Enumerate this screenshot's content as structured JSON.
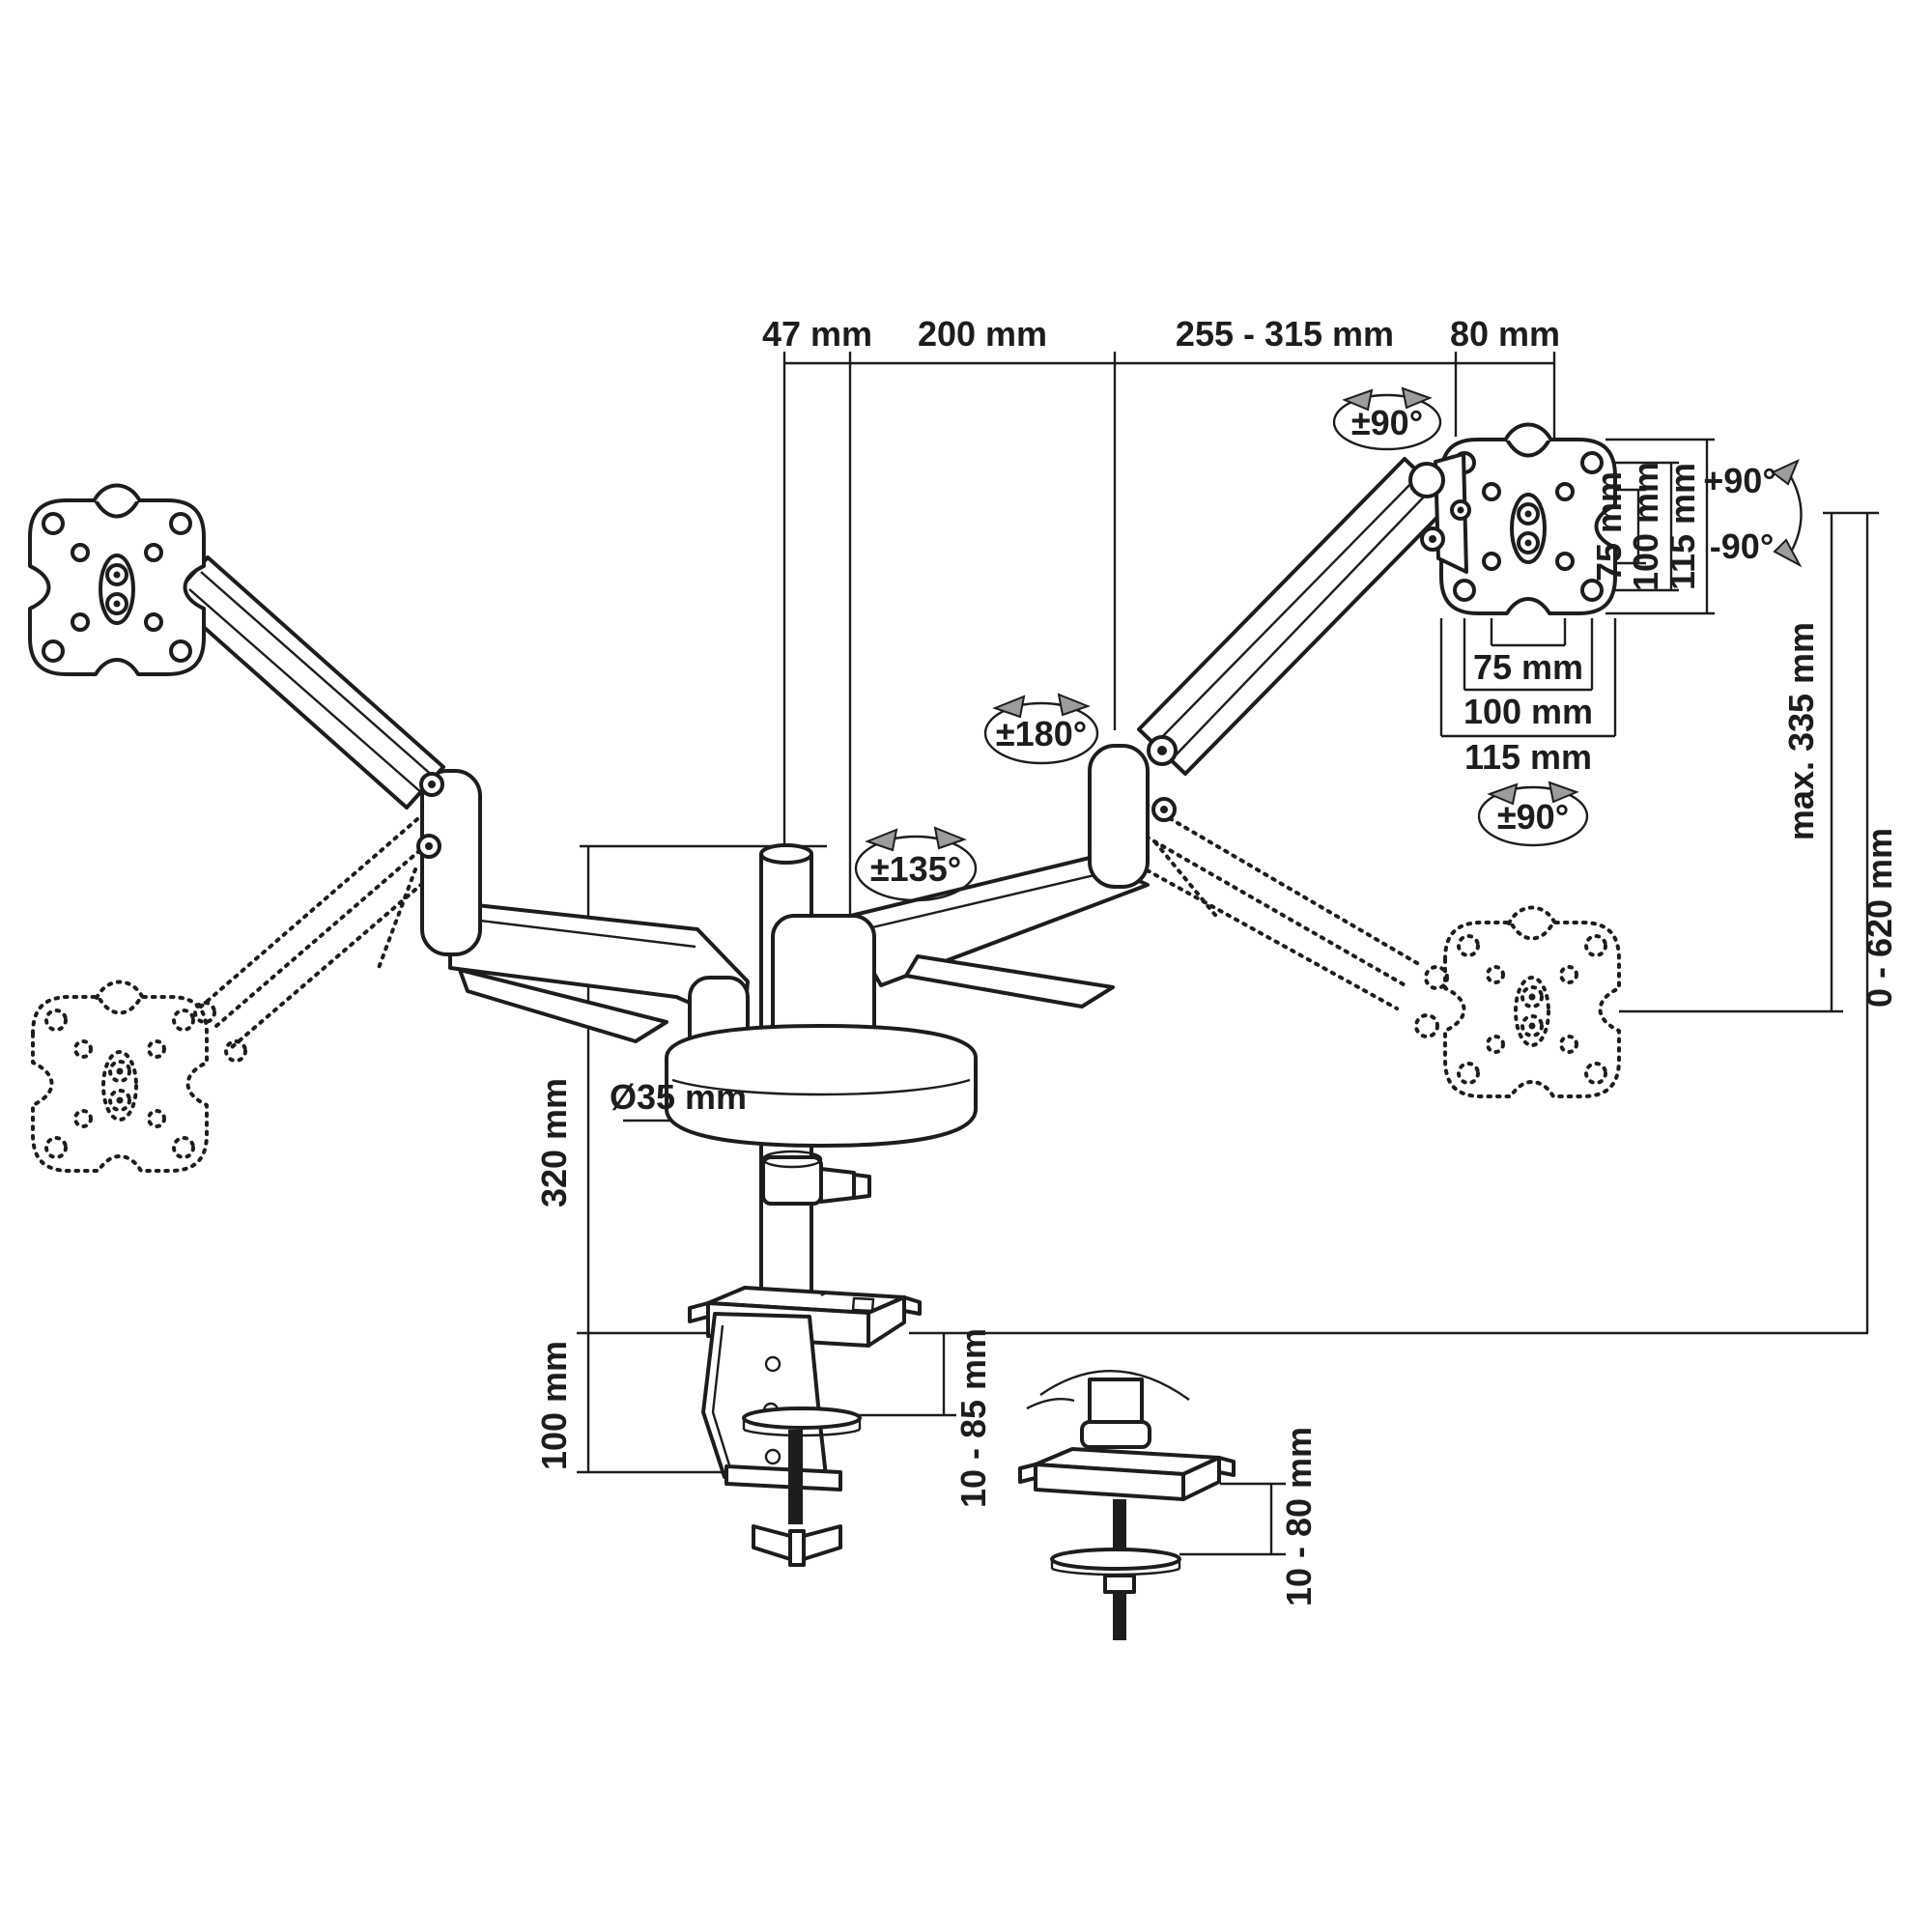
{
  "figure": {
    "type": "technical-dimension-drawing",
    "subject": "dual-monitor gas-spring desk mount arm",
    "background_color": "#ffffff",
    "line_color": "#1d1d1b",
    "arrow_color": "#9c9c9b"
  },
  "dims": {
    "top": {
      "d47": "47 mm",
      "d200": "200 mm",
      "d255": "255 - 315 mm",
      "d80": "80 mm"
    },
    "vesa_side": {
      "v75": "75 mm",
      "v100": "100 mm",
      "v115": "115 mm"
    },
    "vesa_bottom": {
      "h75": "75 mm",
      "h100": "100 mm",
      "h115": "115 mm"
    },
    "left": {
      "pole": "320 mm",
      "dia": "Ø35 mm",
      "clamp": "100 mm"
    },
    "right": {
      "lift": "max. 335 mm",
      "range": "0 - 620 mm"
    },
    "clamp": {
      "desk": "10 - 85 mm",
      "grommet": "10 - 80 mm"
    }
  },
  "rot": {
    "head": "±90°",
    "elbow": "±180°",
    "shoulder": "±135°",
    "plate": "±90°",
    "tiltup": "+90°",
    "tiltdown": "-90°"
  }
}
